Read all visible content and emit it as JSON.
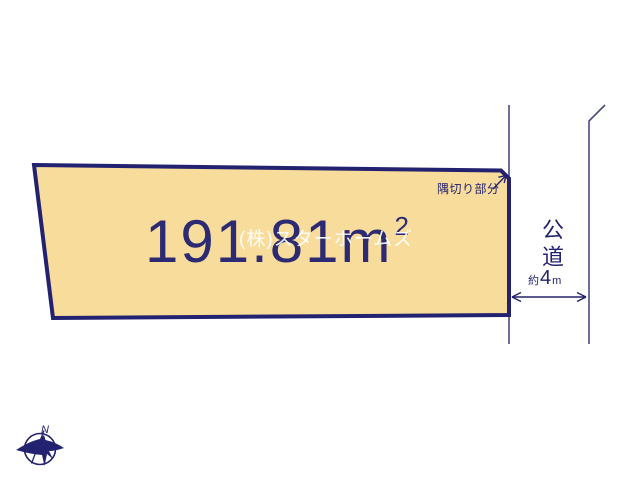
{
  "colors": {
    "background": "#ffffff",
    "plot_fill": "#f8dc9b",
    "plot_border_navy": "#232270",
    "big_text_navy": "#2b2a72",
    "thin_road_line": "#4a4a7d",
    "watermark_white": "#ffffff"
  },
  "plot": {
    "area_value": "191.81",
    "area_unit": "m",
    "area_superscript": "2",
    "corner_cut_label": "隅切り部分"
  },
  "road": {
    "name": "公道",
    "width_approx_prefix": "約",
    "width_value": "4",
    "width_unit": "m"
  },
  "watermark": {
    "text": "(株)スターホームズ"
  },
  "compass": {
    "north_label": "N"
  }
}
